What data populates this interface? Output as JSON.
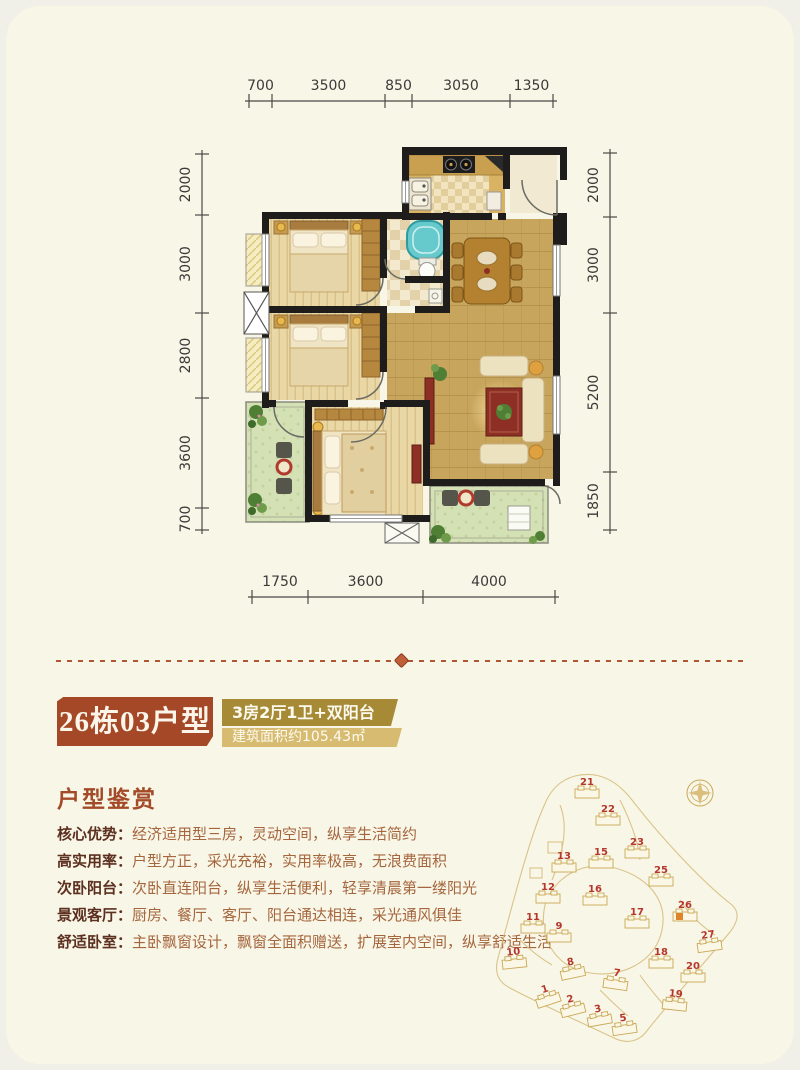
{
  "title_block": {
    "unit_name": "26栋03户型",
    "layout_desc": "3房2厅1卫+双阳台",
    "area_desc": "建筑面积约105.43㎡",
    "unit_bg": "#A54827",
    "layout_bg": "#A78A36",
    "area_bg": "#D7BB70"
  },
  "appreciation": {
    "heading": "户型鉴赏",
    "features": [
      {
        "label": "核心优势：",
        "text": "经济适用型三房，灵动空间，纵享生活简约"
      },
      {
        "label": "高实用率：",
        "text": "户型方正，采光充裕，实用率极高，无浪费面积"
      },
      {
        "label": "次卧阳台：",
        "text": "次卧直连阳台，纵享生活便利，轻享清晨第一缕阳光"
      },
      {
        "label": "景观客厅：",
        "text": "厨房、餐厅、客厅、阳台通达相连，采光通风俱佳"
      },
      {
        "label": "舒适卧室：",
        "text": "主卧飘窗设计，飘窗全面积赠送，扩展室内空间，纵享舒适生活"
      }
    ]
  },
  "floorplan": {
    "dimensions_mm": {
      "top": [
        "700",
        "3500",
        "850",
        "3050",
        "1350"
      ],
      "left": [
        "2000",
        "3000",
        "2800",
        "3600",
        "700"
      ],
      "right": [
        "2000",
        "3000",
        "5200",
        "1850"
      ],
      "bottom": [
        "1750",
        "3600",
        "4000"
      ]
    }
  },
  "sitemap": {
    "buildings": [
      "21",
      "22",
      "23",
      "15",
      "13",
      "25",
      "12",
      "16",
      "26",
      "17",
      "11",
      "9",
      "27",
      "10",
      "18",
      "8",
      "20",
      "7",
      "19",
      "1",
      "2",
      "3",
      "5"
    ],
    "highlighted_building": "26",
    "number_color": "#B5372B",
    "outline_color": "#C9A855",
    "highlight_color": "#E08428"
  },
  "divider_color": "#B05634"
}
